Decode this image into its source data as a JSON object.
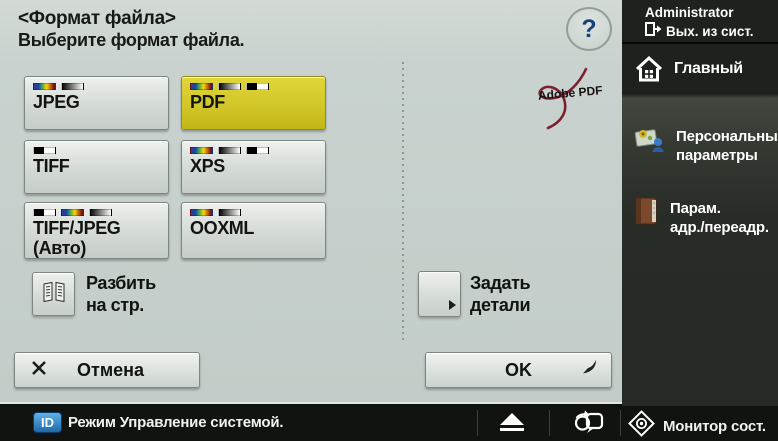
{
  "header": {
    "title": "<Формат файла>",
    "subtitle": "Выберите формат файла.",
    "help": "?"
  },
  "formats": [
    {
      "label": "JPEG",
      "label2": "",
      "indicators": [
        "color",
        "grad"
      ],
      "selected": false
    },
    {
      "label": "PDF",
      "label2": "",
      "indicators": [
        "color",
        "grad",
        "bw"
      ],
      "selected": true
    },
    {
      "label": "TIFF",
      "label2": "",
      "indicators": [
        "bw"
      ],
      "selected": false
    },
    {
      "label": "XPS",
      "label2": "",
      "indicators": [
        "color",
        "grad",
        "bw"
      ],
      "selected": false
    },
    {
      "label": "TIFF/JPEG",
      "label2": "(Авто)",
      "indicators": [
        "bw",
        "color",
        "grad"
      ],
      "selected": false
    },
    {
      "label": "OOXML",
      "label2": "",
      "indicators": [
        "color",
        "grad"
      ],
      "selected": false
    }
  ],
  "options": {
    "divide_pages": {
      "line1": "Разбить",
      "line2": "на стр."
    },
    "set_details": {
      "line1": "Задать",
      "line2": "детали"
    },
    "adobe_pdf": "Adobe PDF"
  },
  "actions": {
    "cancel": "Отмена",
    "ok": "OK"
  },
  "sidebar": {
    "user": "Administrator",
    "logout": "Вых. из сист.",
    "items": [
      {
        "line1": "Главный",
        "line2": ""
      },
      {
        "line1": "Персональные",
        "line2": "параметры"
      },
      {
        "line1": "Парам.",
        "line2": "адр./переадр."
      }
    ]
  },
  "statusbar": {
    "id_badge": "ID",
    "mode": "Режим Управление системой.",
    "monitor": "Монитор сост."
  },
  "colors": {
    "selected_yellow": "#d2c629",
    "badge_blue": "#2f7fc0",
    "adobe_red": "#7c2130"
  }
}
